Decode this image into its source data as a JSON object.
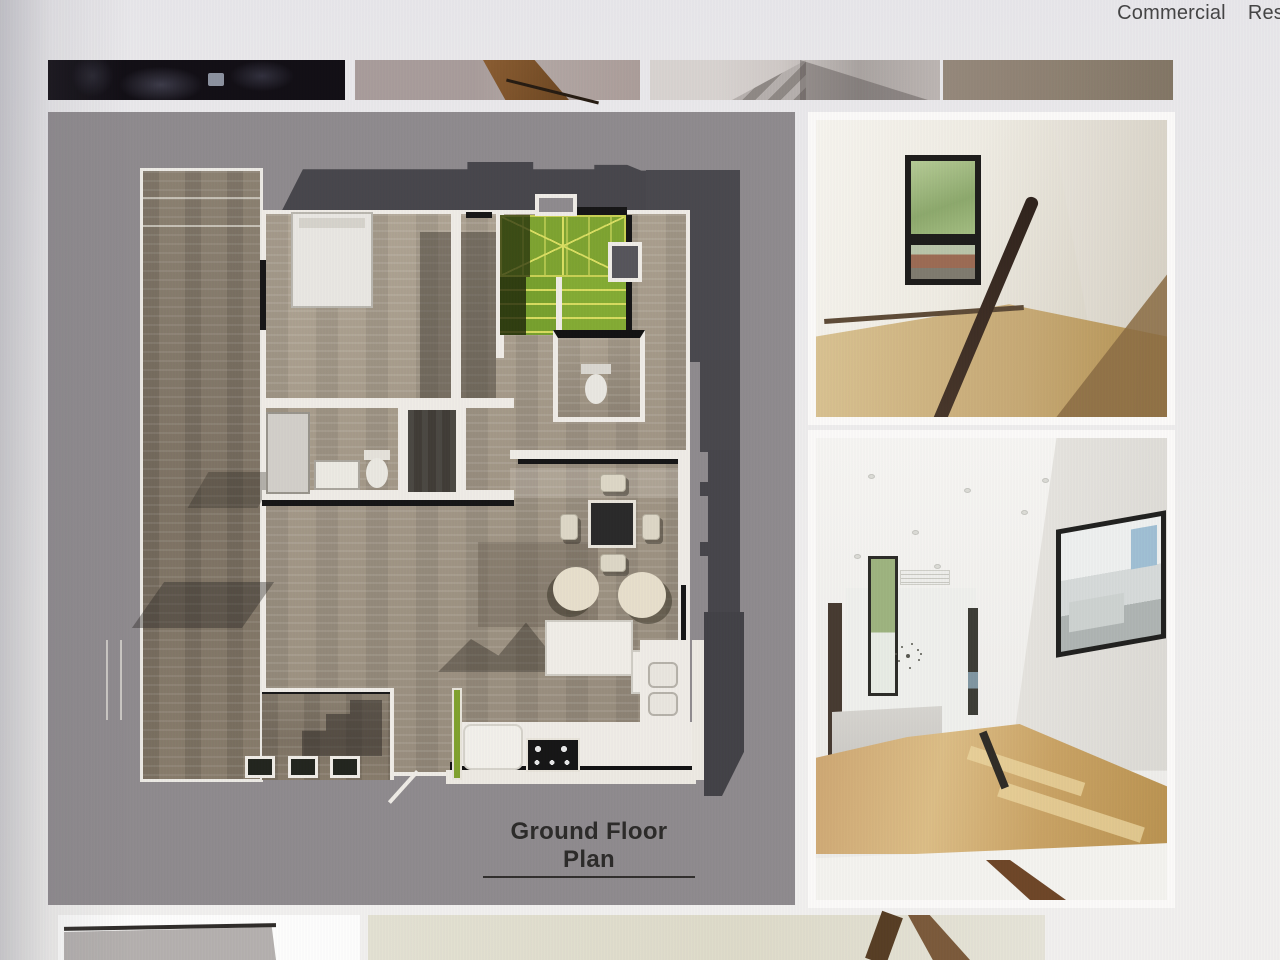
{
  "nav": {
    "items": [
      {
        "label": "Commercial"
      },
      {
        "label": "Res"
      }
    ]
  },
  "plan": {
    "title": "Ground Floor Plan"
  },
  "colors": {
    "page_bg": "#eceaec",
    "nav_text": "#434343",
    "plan_bg": "#8e8a8d",
    "roof": "#46454a",
    "stair_green": "#7da32f",
    "wall_white": "#efece6",
    "wood_deck": "#85796a",
    "wood_floor": "#a79c8b",
    "photo_wood": "#c9a46c",
    "title_color": "#2a2927"
  }
}
